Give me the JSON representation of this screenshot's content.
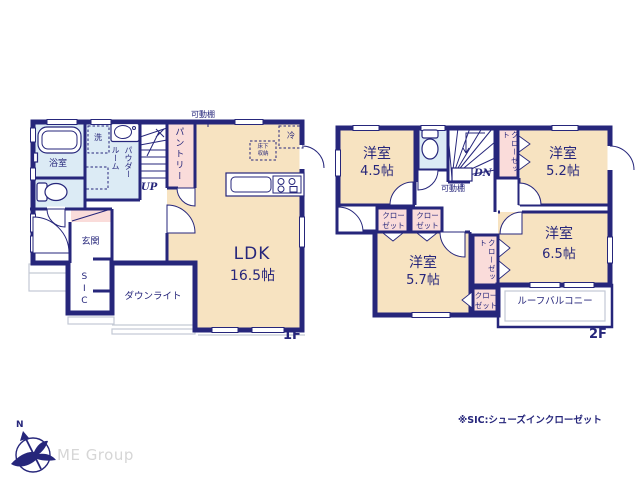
{
  "colors": {
    "wall_navy": "#26267b",
    "room_cream": "#f7e3c1",
    "room_pink": "#fadcda",
    "room_blue": "#dcebf5",
    "exterior_gray": "#c3c9d4",
    "logo_gray": "#d6d6d6"
  },
  "floor1": {
    "label": "1F",
    "bathroom": "浴室",
    "washer": "洗",
    "powder_room": "パウダールーム",
    "pantry": "パントリー",
    "stairs_up": "UP",
    "shelf": "可動棚",
    "ldk_name": "LDK",
    "ldk_size": "16.5帖",
    "fridge": "冷",
    "underfloor_storage": "床下収納",
    "entrance": "玄関",
    "shoe_closet": "SIC",
    "downlight": "ダウンライト"
  },
  "floor2": {
    "label": "2F",
    "rooms": [
      {
        "name": "洋室",
        "size": "4.5帖"
      },
      {
        "name": "洋室",
        "size": "5.2帖"
      },
      {
        "name": "洋室",
        "size": "5.7帖"
      },
      {
        "name": "洋室",
        "size": "6.5帖"
      }
    ],
    "closets": [
      "クローゼット",
      "クローゼット",
      "クローゼット",
      "クローゼット",
      "クローゼット"
    ],
    "stairs_down": "DN",
    "shelf": "可動棚",
    "balcony": "ルーフバルコニー"
  },
  "footer": {
    "sic_note": "※SIC:シューズインクローゼット",
    "logo_text": "ME Group",
    "compass_north": "N"
  }
}
